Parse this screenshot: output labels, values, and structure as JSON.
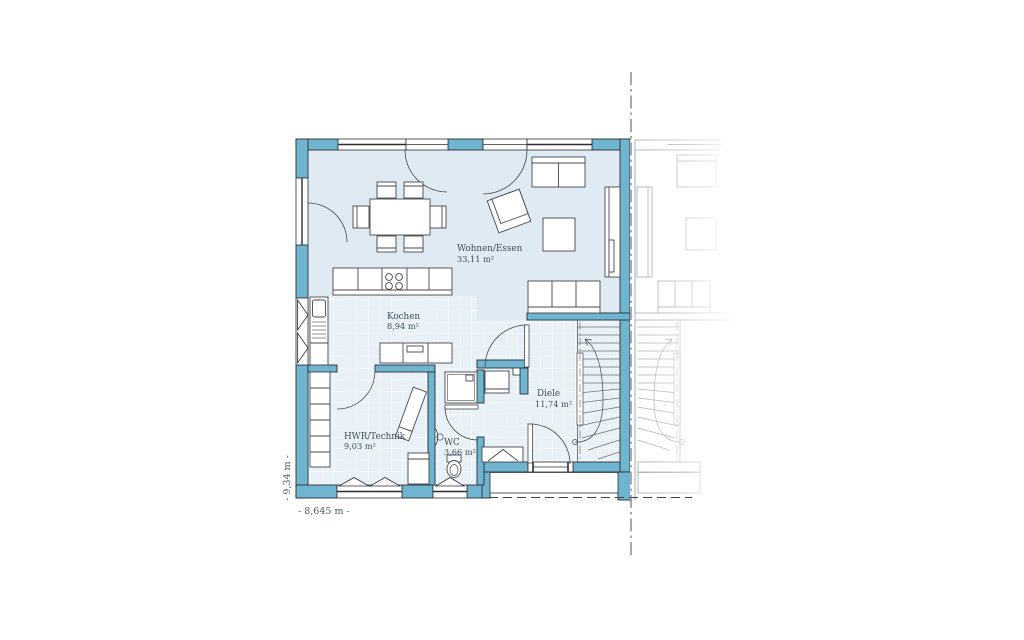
{
  "rooms": [
    {
      "name": "Wohnen/Essen",
      "area": "33,11 m²"
    },
    {
      "name": "Kochen",
      "area": "8,94 m²"
    },
    {
      "name": "HWR/Technik",
      "area": "9,03 m²"
    },
    {
      "name": "WC",
      "area": "3,66 m²"
    },
    {
      "name": "Diele",
      "area": "11,74 m²"
    }
  ],
  "dimensions": {
    "width_label": "- 8,645 m -",
    "height_label": "- 9,34 m -"
  },
  "colors": {
    "wall_fill": "#6fb5d0",
    "wall_stroke": "#2b2f34",
    "floor": "#dfeaf2",
    "tile_floor": "#e8f1f7",
    "furniture_stroke": "#44484e",
    "neighbor_gray": "#a9adb1",
    "label_text": "#3f4e5a"
  }
}
